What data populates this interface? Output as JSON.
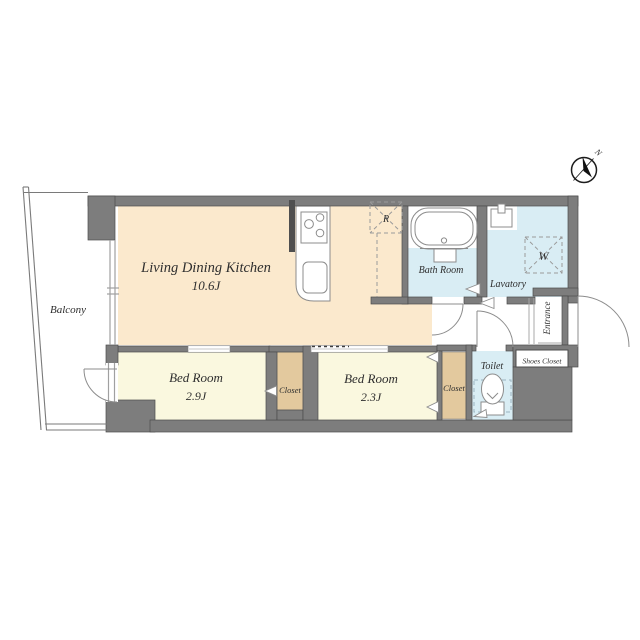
{
  "title": "Apartment floor plan",
  "compass": {
    "north_label": "N"
  },
  "rooms": {
    "ldk": {
      "name": "Living Dining Kitchen",
      "size": "10.6J"
    },
    "bedroom1": {
      "name": "Bed Room",
      "size": "2.9J"
    },
    "bedroom2": {
      "name": "Bed Room",
      "size": "2.3J"
    },
    "balcony": {
      "name": "Balcony"
    },
    "bath": {
      "name": "Bath Room"
    },
    "lavatory": {
      "name": "Lavatory"
    },
    "toilet": {
      "name": "Toilet"
    },
    "closet1": {
      "name": "Closet"
    },
    "closet2": {
      "name": "Closet"
    },
    "shoes_closet": {
      "name": "Shoes Closet"
    },
    "entrance": {
      "name": "Entrance"
    }
  },
  "fixtures": {
    "refrigerator_label": "R",
    "washer_label": "W"
  },
  "colors": {
    "wall": "#7d7d7d",
    "wall-line": "#4c4c4c",
    "wall-dark": "#4f4f4f",
    "ldk": "#fbe9cd",
    "bedroom": "#faf8df",
    "closet": "#e3c99e",
    "wet": "#d9edf4"
  }
}
